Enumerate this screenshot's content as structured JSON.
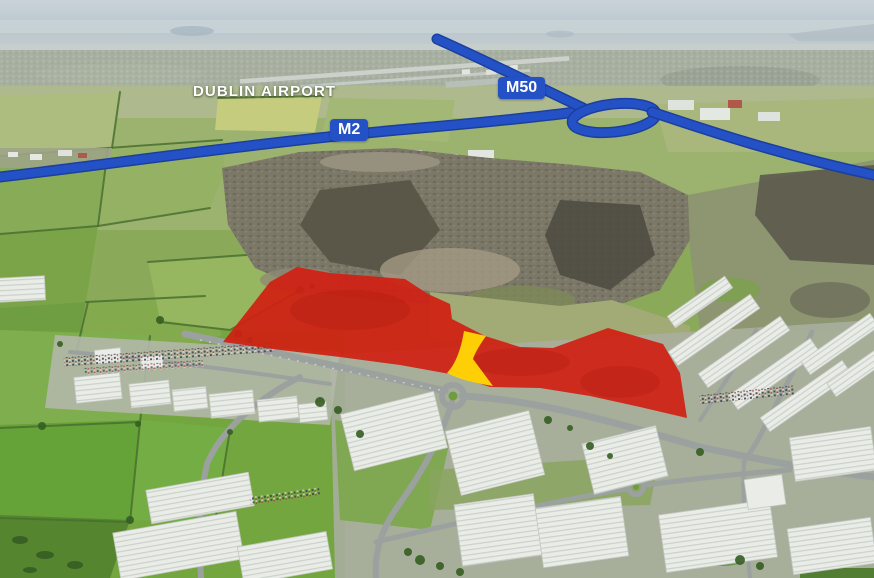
{
  "map": {
    "type": "annotated-aerial-photograph",
    "labels": {
      "airport": "DUBLIN AIRPORT",
      "m2": "M2",
      "m50": "M50"
    },
    "colors": {
      "site_fill": "#d02012",
      "access_strip": "#ffd405",
      "motorway_line": "#2452c6",
      "label_text": "#ffffff"
    }
  }
}
